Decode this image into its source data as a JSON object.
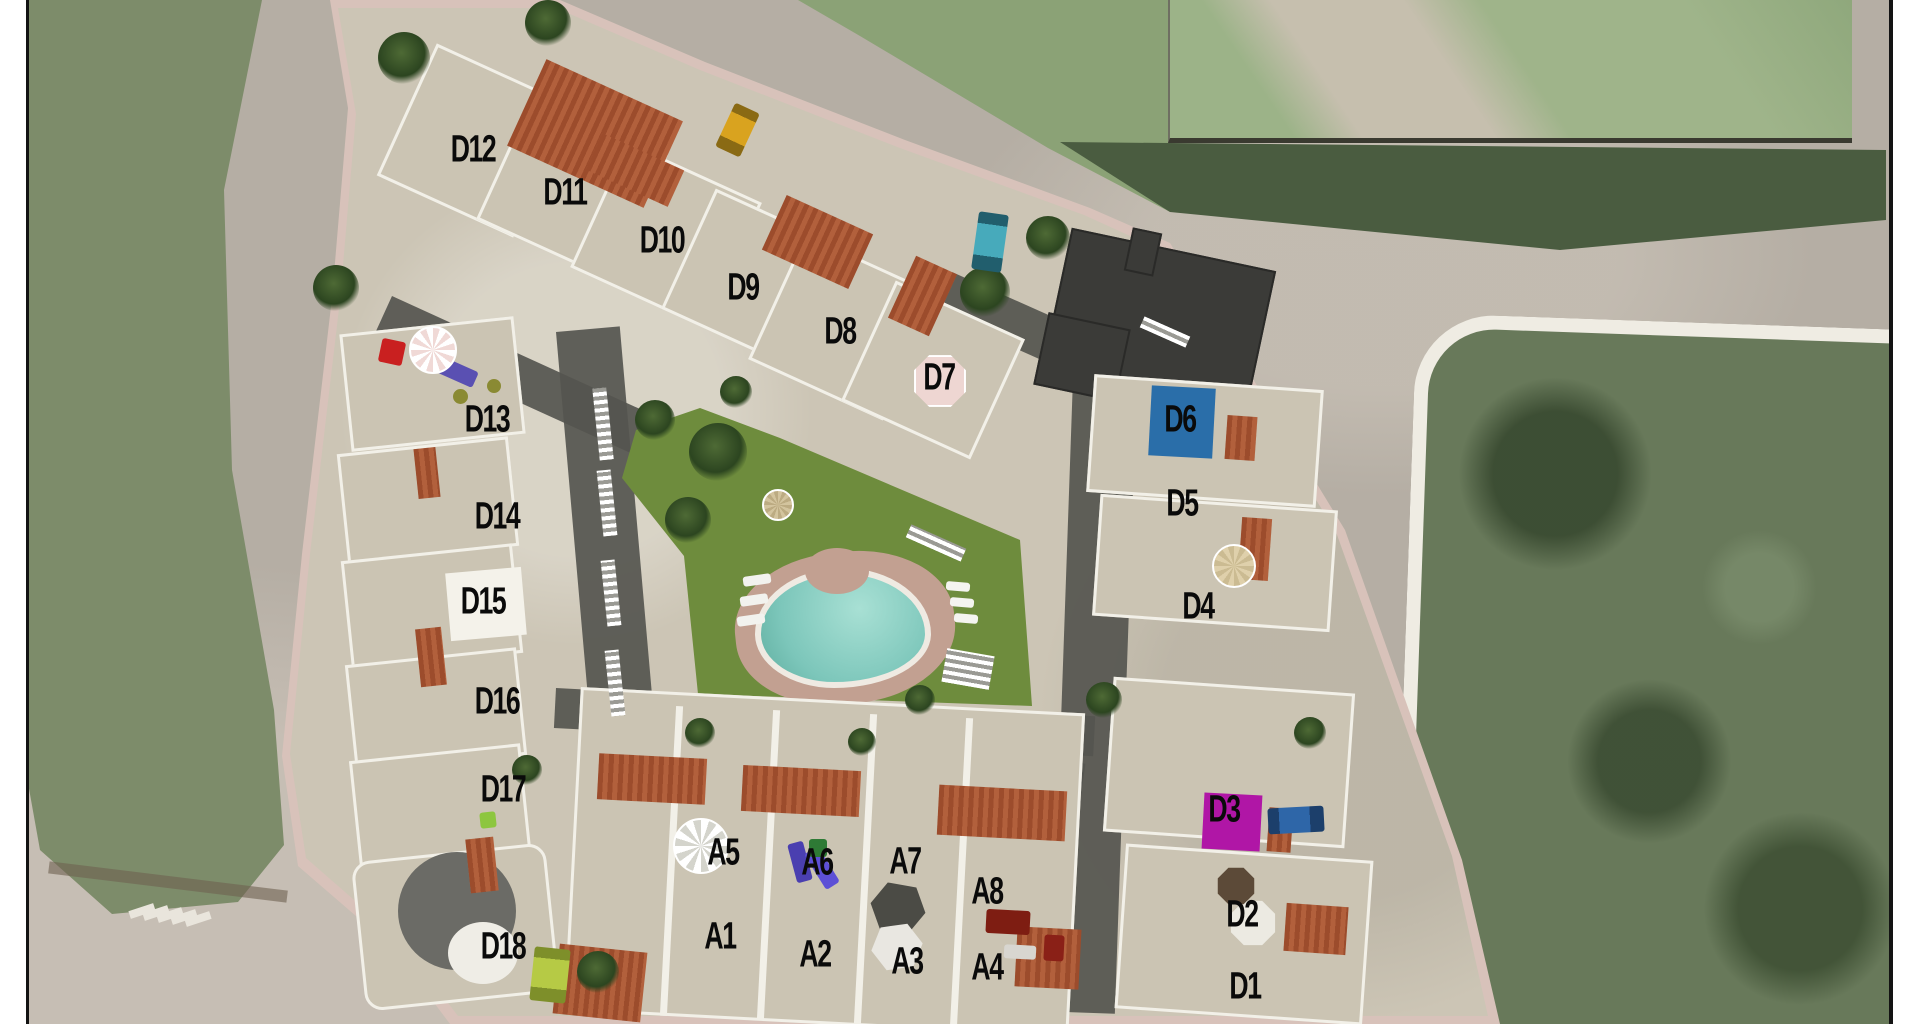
{
  "scene": {
    "title": "Residential development aerial site plan",
    "colors": {
      "road": "#b5aea4",
      "field": "#7d8c6a",
      "parcel": "#68795a",
      "lawn": "#6e8c3d",
      "pool_water": "#7cc6ba",
      "pool_deck": "#c2a091",
      "building": "#ccc5b5",
      "site_rim": "#d8c2ba",
      "roof_tile": "#9c4c2c",
      "alley": "#55554f",
      "badge_blue": "#2a6ea9",
      "badge_magenta": "#b016a6",
      "badge_pink": "#eed6d2",
      "badge_white": "#f4f2ea",
      "label_text": "#0a0a0a"
    }
  },
  "units": [
    {
      "id": "D12",
      "x": 473,
      "y": 150
    },
    {
      "id": "D11",
      "x": 565,
      "y": 193
    },
    {
      "id": "D10",
      "x": 662,
      "y": 241
    },
    {
      "id": "D9",
      "x": 743,
      "y": 288
    },
    {
      "id": "D8",
      "x": 840,
      "y": 332
    },
    {
      "id": "D7",
      "x": 939,
      "y": 378,
      "badge": {
        "shape": "oct",
        "color": "#eed6d2",
        "border": "#ffffff",
        "w": 54,
        "h": 54,
        "dx": 1,
        "dy": 3,
        "rot": 0
      }
    },
    {
      "id": "D6",
      "x": 1180,
      "y": 420,
      "badge": {
        "shape": "rect",
        "color": "#2a6ea9",
        "w": 64,
        "h": 70,
        "dx": 2,
        "dy": 2,
        "rot": 3
      }
    },
    {
      "id": "D5",
      "x": 1182,
      "y": 504
    },
    {
      "id": "D4",
      "x": 1198,
      "y": 607
    },
    {
      "id": "D13",
      "x": 487,
      "y": 420
    },
    {
      "id": "D14",
      "x": 497,
      "y": 517
    },
    {
      "id": "D15",
      "x": 483,
      "y": 602,
      "badge": {
        "shape": "rect",
        "color": "#f4f2ea",
        "w": 76,
        "h": 68,
        "dx": 3,
        "dy": 2,
        "rot": -5
      }
    },
    {
      "id": "D16",
      "x": 497,
      "y": 702
    },
    {
      "id": "D17",
      "x": 503,
      "y": 790
    },
    {
      "id": "D18",
      "x": 503,
      "y": 947
    },
    {
      "id": "A5",
      "x": 723,
      "y": 853
    },
    {
      "id": "A6",
      "x": 817,
      "y": 863
    },
    {
      "id": "A7",
      "x": 905,
      "y": 862
    },
    {
      "id": "A8",
      "x": 987,
      "y": 892
    },
    {
      "id": "A1",
      "x": 720,
      "y": 937
    },
    {
      "id": "A2",
      "x": 815,
      "y": 955
    },
    {
      "id": "A3",
      "x": 907,
      "y": 962
    },
    {
      "id": "A4",
      "x": 987,
      "y": 968
    },
    {
      "id": "D3",
      "x": 1224,
      "y": 810,
      "badge": {
        "shape": "rect",
        "color": "#b016a6",
        "w": 58,
        "h": 56,
        "dx": 8,
        "dy": 12,
        "rot": 3
      }
    },
    {
      "id": "D2",
      "x": 1242,
      "y": 915
    },
    {
      "id": "D1",
      "x": 1245,
      "y": 987
    }
  ],
  "objects": [
    {
      "name": "yellow-car",
      "shape": "rect",
      "x": 737,
      "y": 130,
      "w": 27,
      "h": 48,
      "rot": 25,
      "color": "#d9a31f",
      "stripe": "#8a6a14"
    },
    {
      "name": "teal-car",
      "shape": "rect",
      "x": 990,
      "y": 242,
      "w": 30,
      "h": 58,
      "rot": 8,
      "color": "#47aabb",
      "stripe": "#215e6d"
    },
    {
      "name": "blue-car",
      "shape": "rect",
      "x": 1296,
      "y": 820,
      "w": 56,
      "h": 26,
      "rot": -3,
      "color": "#2e66a8",
      "stripe": "#1c3f6b",
      "horizontal": true
    },
    {
      "name": "lime-car",
      "shape": "rect",
      "x": 550,
      "y": 975,
      "w": 36,
      "h": 54,
      "rot": 6,
      "color": "#b6ca45",
      "stripe": "#7e8f2a"
    },
    {
      "name": "red-chair",
      "shape": "rect",
      "x": 392,
      "y": 352,
      "w": 24,
      "h": 24,
      "rot": 12,
      "color": "#c92020"
    },
    {
      "name": "purple-sofa",
      "shape": "rect",
      "x": 458,
      "y": 372,
      "w": 38,
      "h": 17,
      "rot": 24,
      "color": "#5a50b2"
    },
    {
      "name": "olive-pot",
      "shape": "circle",
      "x": 460,
      "y": 396,
      "w": 15,
      "h": 15,
      "color": "#8a8a33"
    },
    {
      "name": "olive-pot",
      "shape": "circle",
      "x": 494,
      "y": 386,
      "w": 14,
      "h": 14,
      "color": "#8a8a33"
    },
    {
      "name": "pink-umbrella",
      "shape": "umbrella",
      "x": 433,
      "y": 350,
      "w": 48,
      "h": 48,
      "color": "#f0d9d6",
      "alt": "#ffffff"
    },
    {
      "name": "beige-umbrella",
      "shape": "umbrella",
      "x": 1234,
      "y": 566,
      "w": 44,
      "h": 44,
      "color": "#dfd0ab",
      "alt": "#cbbb92"
    },
    {
      "name": "white-fan-umbrella",
      "shape": "umbrella",
      "x": 701,
      "y": 846,
      "w": 56,
      "h": 56,
      "color": "#ffffff",
      "alt": "#d4d4cc"
    },
    {
      "name": "lawn-parasol",
      "shape": "umbrella",
      "x": 778,
      "y": 505,
      "w": 32,
      "h": 32,
      "color": "#d3c49e",
      "alt": "#bcab82"
    },
    {
      "name": "dark-umbrella",
      "shape": "hex",
      "x": 898,
      "y": 908,
      "w": 58,
      "h": 52,
      "rot": 10,
      "color": "#4b4b45"
    },
    {
      "name": "white-umbrella",
      "shape": "hex",
      "x": 897,
      "y": 947,
      "w": 54,
      "h": 48,
      "rot": -8,
      "color": "#e9e7e1"
    },
    {
      "name": "white-parasol",
      "shape": "oct",
      "x": 1253,
      "y": 923,
      "w": 46,
      "h": 46,
      "rot": 0,
      "color": "#eceae2"
    },
    {
      "name": "brown-parasol",
      "shape": "oct",
      "x": 1236,
      "y": 886,
      "w": 38,
      "h": 38,
      "rot": 0,
      "color": "#5c4a38"
    },
    {
      "name": "purple-lounger",
      "shape": "rect",
      "x": 800,
      "y": 862,
      "w": 16,
      "h": 40,
      "rot": -15,
      "color": "#4a3fb0"
    },
    {
      "name": "purple-lounger",
      "shape": "rect",
      "x": 822,
      "y": 868,
      "w": 16,
      "h": 42,
      "rot": -32,
      "color": "#5d50d6"
    },
    {
      "name": "green-planter",
      "shape": "rect",
      "x": 818,
      "y": 848,
      "w": 18,
      "h": 18,
      "rot": 0,
      "color": "#2e7a35"
    },
    {
      "name": "green-box",
      "shape": "rect",
      "x": 488,
      "y": 820,
      "w": 16,
      "h": 16,
      "rot": -6,
      "color": "#8dc63f"
    },
    {
      "name": "red-table",
      "shape": "rect",
      "x": 1008,
      "y": 922,
      "w": 44,
      "h": 24,
      "rot": 3,
      "color": "#7e1d12"
    },
    {
      "name": "white-mat",
      "shape": "rect",
      "x": 1020,
      "y": 952,
      "w": 32,
      "h": 14,
      "rot": 3,
      "color": "#d8d6d0"
    },
    {
      "name": "red-chair",
      "shape": "rect",
      "x": 1054,
      "y": 948,
      "w": 20,
      "h": 26,
      "rot": 3,
      "color": "#8a2017"
    },
    {
      "name": "sun-lounger",
      "shape": "rect",
      "x": 757,
      "y": 580,
      "w": 28,
      "h": 10,
      "rot": -8,
      "color": "#f2f2ee"
    },
    {
      "name": "sun-lounger",
      "shape": "rect",
      "x": 754,
      "y": 600,
      "w": 28,
      "h": 10,
      "rot": -8,
      "color": "#f2f2ee"
    },
    {
      "name": "sun-lounger",
      "shape": "rect",
      "x": 751,
      "y": 620,
      "w": 28,
      "h": 10,
      "rot": -8,
      "color": "#f2f2ee"
    },
    {
      "name": "sun-mat",
      "shape": "rect",
      "x": 958,
      "y": 586,
      "w": 24,
      "h": 9,
      "rot": 5,
      "color": "#f4f4f0"
    },
    {
      "name": "sun-mat",
      "shape": "rect",
      "x": 962,
      "y": 602,
      "w": 24,
      "h": 9,
      "rot": 5,
      "color": "#f4f4f0"
    },
    {
      "name": "sun-mat",
      "shape": "rect",
      "x": 966,
      "y": 618,
      "w": 24,
      "h": 9,
      "rot": 5,
      "color": "#f4f4f0"
    }
  ]
}
